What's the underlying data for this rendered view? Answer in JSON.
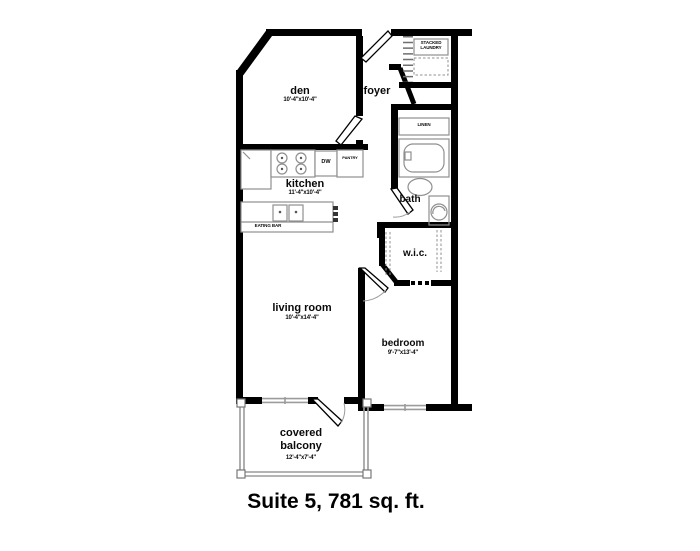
{
  "title": "Suite 5, 781 sq. ft.",
  "colors": {
    "wall": "#000000",
    "fixture_line": "#8f8f8f",
    "window_line": "#9b9b9b",
    "text": "#0a0a0a"
  },
  "rooms": {
    "den": {
      "name": "den",
      "dims": "10'-4\"x10'-4\""
    },
    "foyer": {
      "name": "foyer"
    },
    "kitchen": {
      "name": "kitchen",
      "dims": "11'-4\"x10'-4\""
    },
    "bath": {
      "name": "bath"
    },
    "wic": {
      "name": "w.i.c."
    },
    "living_room": {
      "name": "living room",
      "dims": "10'-4\"x14'-4\""
    },
    "bedroom": {
      "name": "bedroom",
      "dims": "9'-7\"x13'-4\""
    },
    "balcony": {
      "name_line1": "covered",
      "name_line2": "balcony",
      "dims": "12'-4\"x7'-4\""
    }
  },
  "labels": {
    "stacked_laundry_line1": "STACKED",
    "stacked_laundry_line2": "LAUNDRY",
    "linen": "LINEN",
    "pantry": "PANTRY",
    "dishwasher": "DW",
    "eating_bar": "EATING BAR"
  }
}
